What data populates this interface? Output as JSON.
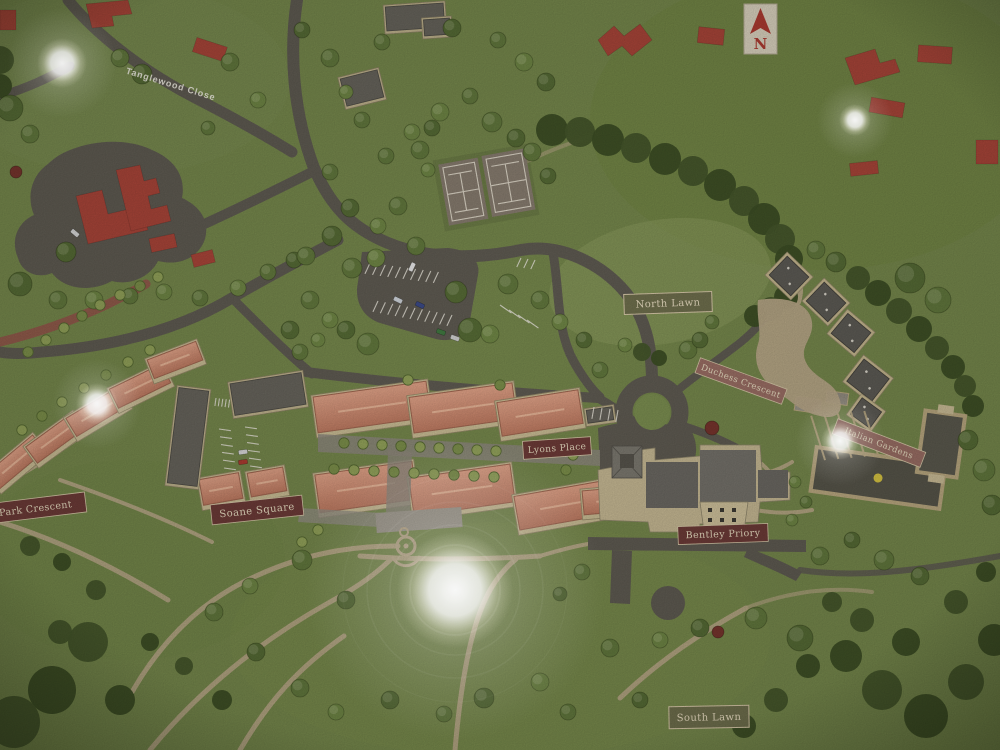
{
  "map": {
    "road_labels": {
      "tanglewood_close": "Tanglewood Close"
    },
    "plaques": [
      {
        "id": "north-lawn",
        "label": "North Lawn",
        "style": "lawn"
      },
      {
        "id": "duchess-crescent",
        "label": "Duchess Crescent",
        "style": "street"
      },
      {
        "id": "lyons-place",
        "label": "Lyons Place",
        "style": "street"
      },
      {
        "id": "soane-square",
        "label": "Soane Square",
        "style": "street"
      },
      {
        "id": "park-crescent",
        "label": "ce Park Crescent",
        "style": "street"
      },
      {
        "id": "bentley-priory",
        "label": "Bentley Priory",
        "style": "street"
      },
      {
        "id": "italian-gardens",
        "label": "Italian Gardens",
        "style": "street"
      },
      {
        "id": "south-lawn",
        "label": "South Lawn",
        "style": "lawn"
      }
    ],
    "compass": {
      "letter": "N"
    },
    "palette": {
      "grass": "#76884a",
      "road": "#5f5b52",
      "path": "#b9a887",
      "plaqueMaroon": "#6e3b37",
      "plaquePink": "#9b6e63",
      "plaqueOlive": "#6f6f4c",
      "plaqueBorder": "#d8c9a8",
      "plaqueText": "#e9ddc0",
      "roofTerracotta": "#d4937a",
      "roofDark": "#5d5b55",
      "wallTan": "#c9bc93",
      "redFootprint": "#ad4438",
      "compassRed": "#b23a30",
      "glare": "#ffffff"
    }
  }
}
